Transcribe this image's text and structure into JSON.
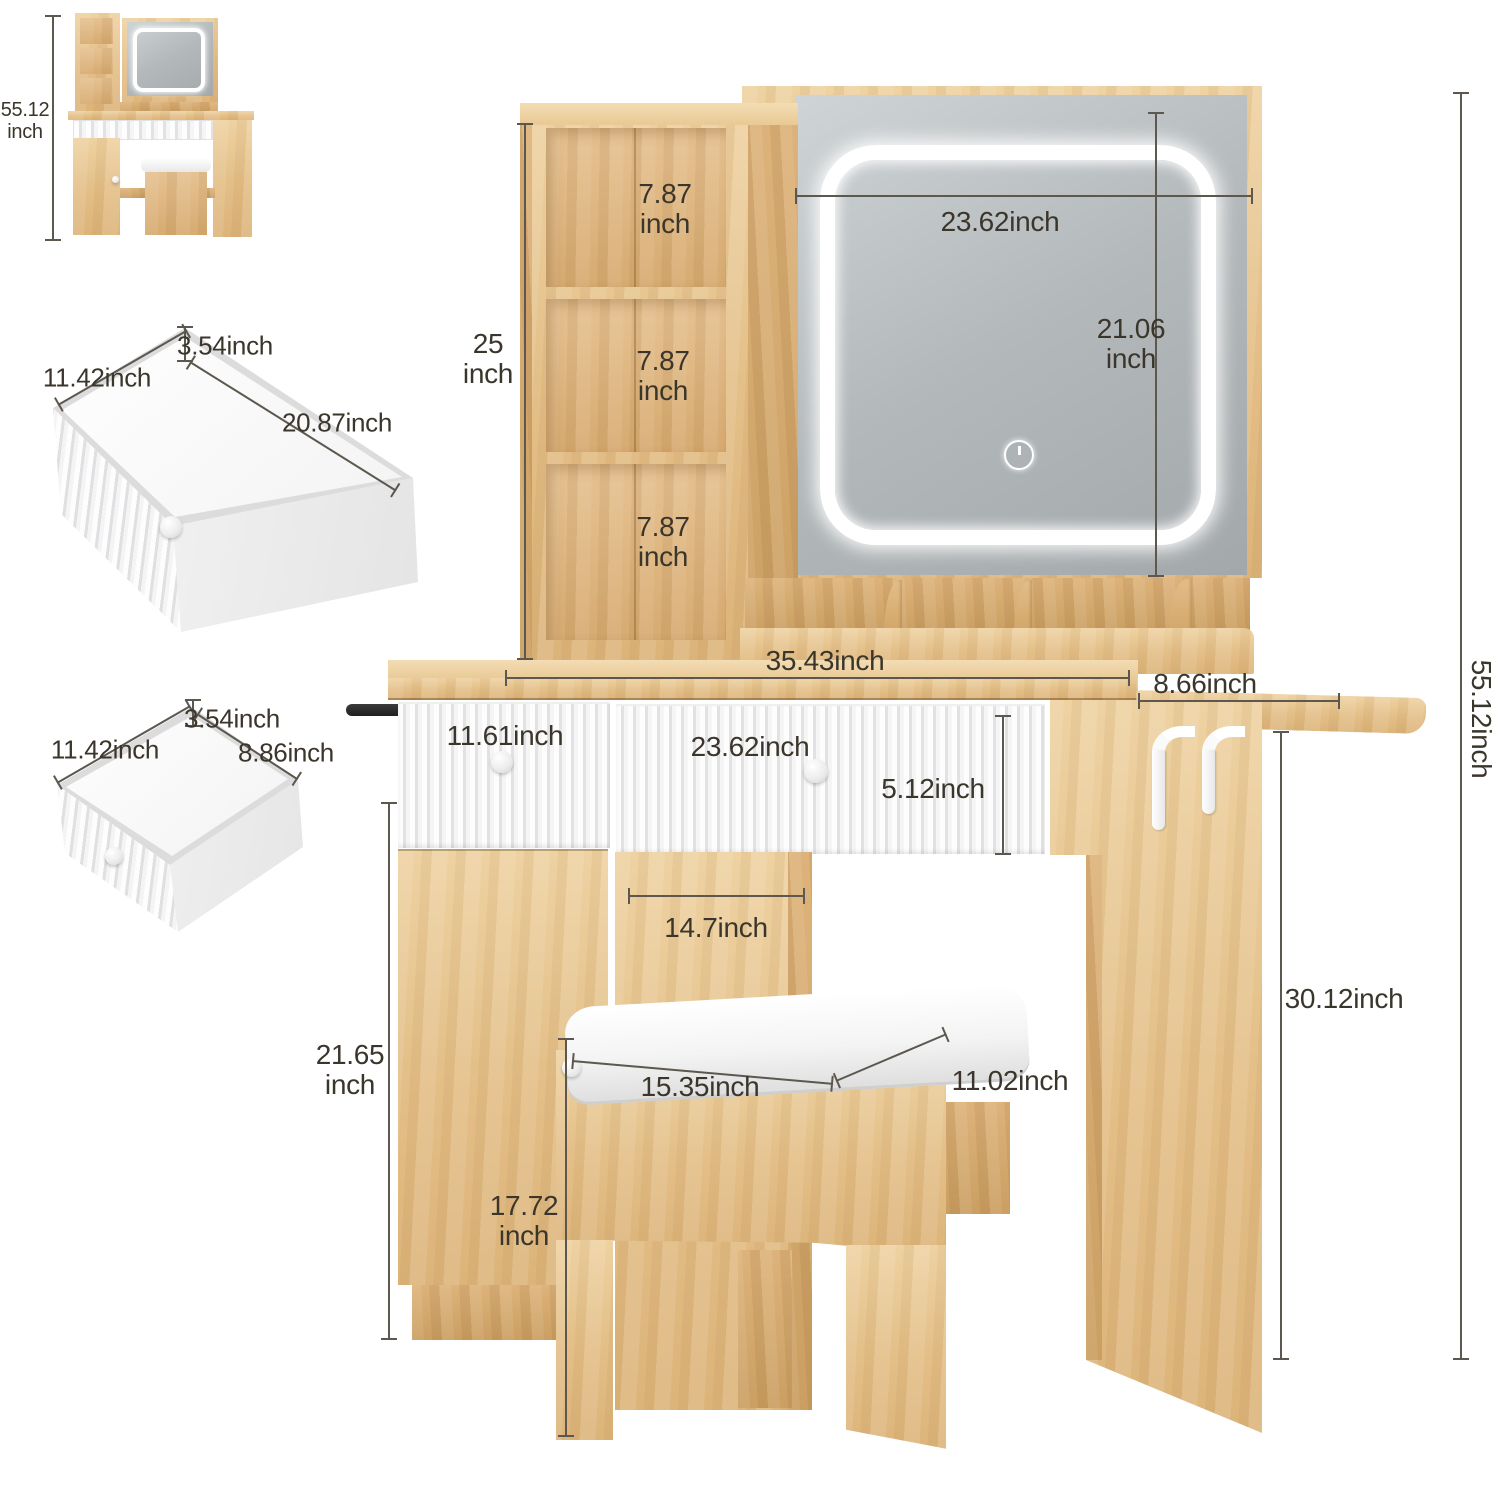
{
  "palette": {
    "wood": "#e7c38f",
    "wood_dark": "#cda264",
    "dim_line": "#5c574f",
    "mirror": "#b7bcbe",
    "led": "#ffffff"
  },
  "thumbnail": {
    "overall_height_num": "55.12",
    "overall_height_unit": "inch"
  },
  "drawer_large": {
    "height": "3.54inch",
    "width": "11.42inch",
    "length": "20.87inch"
  },
  "drawer_small": {
    "height": "3.54inch",
    "width": "11.42inch",
    "depth": "8.86inch"
  },
  "hutch": {
    "shelf_top_num": "7.87",
    "shelf_top_unit": "inch",
    "shelf_mid_num": "7.87",
    "shelf_mid_unit": "inch",
    "shelf_bot_num": "7.87",
    "shelf_bot_unit": "inch",
    "tower_height_num": "25",
    "tower_height_unit": "inch"
  },
  "mirror": {
    "width": "23.62inch",
    "height_num": "21.06",
    "height_unit": "inch"
  },
  "desk": {
    "top_width": "35.43inch",
    "side_shelf_depth": "8.66inch",
    "left_drawer_width": "11.61inch",
    "center_drawer_width": "23.62inch",
    "drawer_height": "5.12inch",
    "knee_width": "14.7inch",
    "cabinet_height_num": "21.65",
    "cabinet_height_unit": "inch",
    "door_height_num": "17.72",
    "door_height_unit": "inch",
    "desk_height": "30.12inch",
    "overall_height": "55.12inch"
  },
  "stool": {
    "width": "15.35inch",
    "depth": "11.02inch"
  }
}
